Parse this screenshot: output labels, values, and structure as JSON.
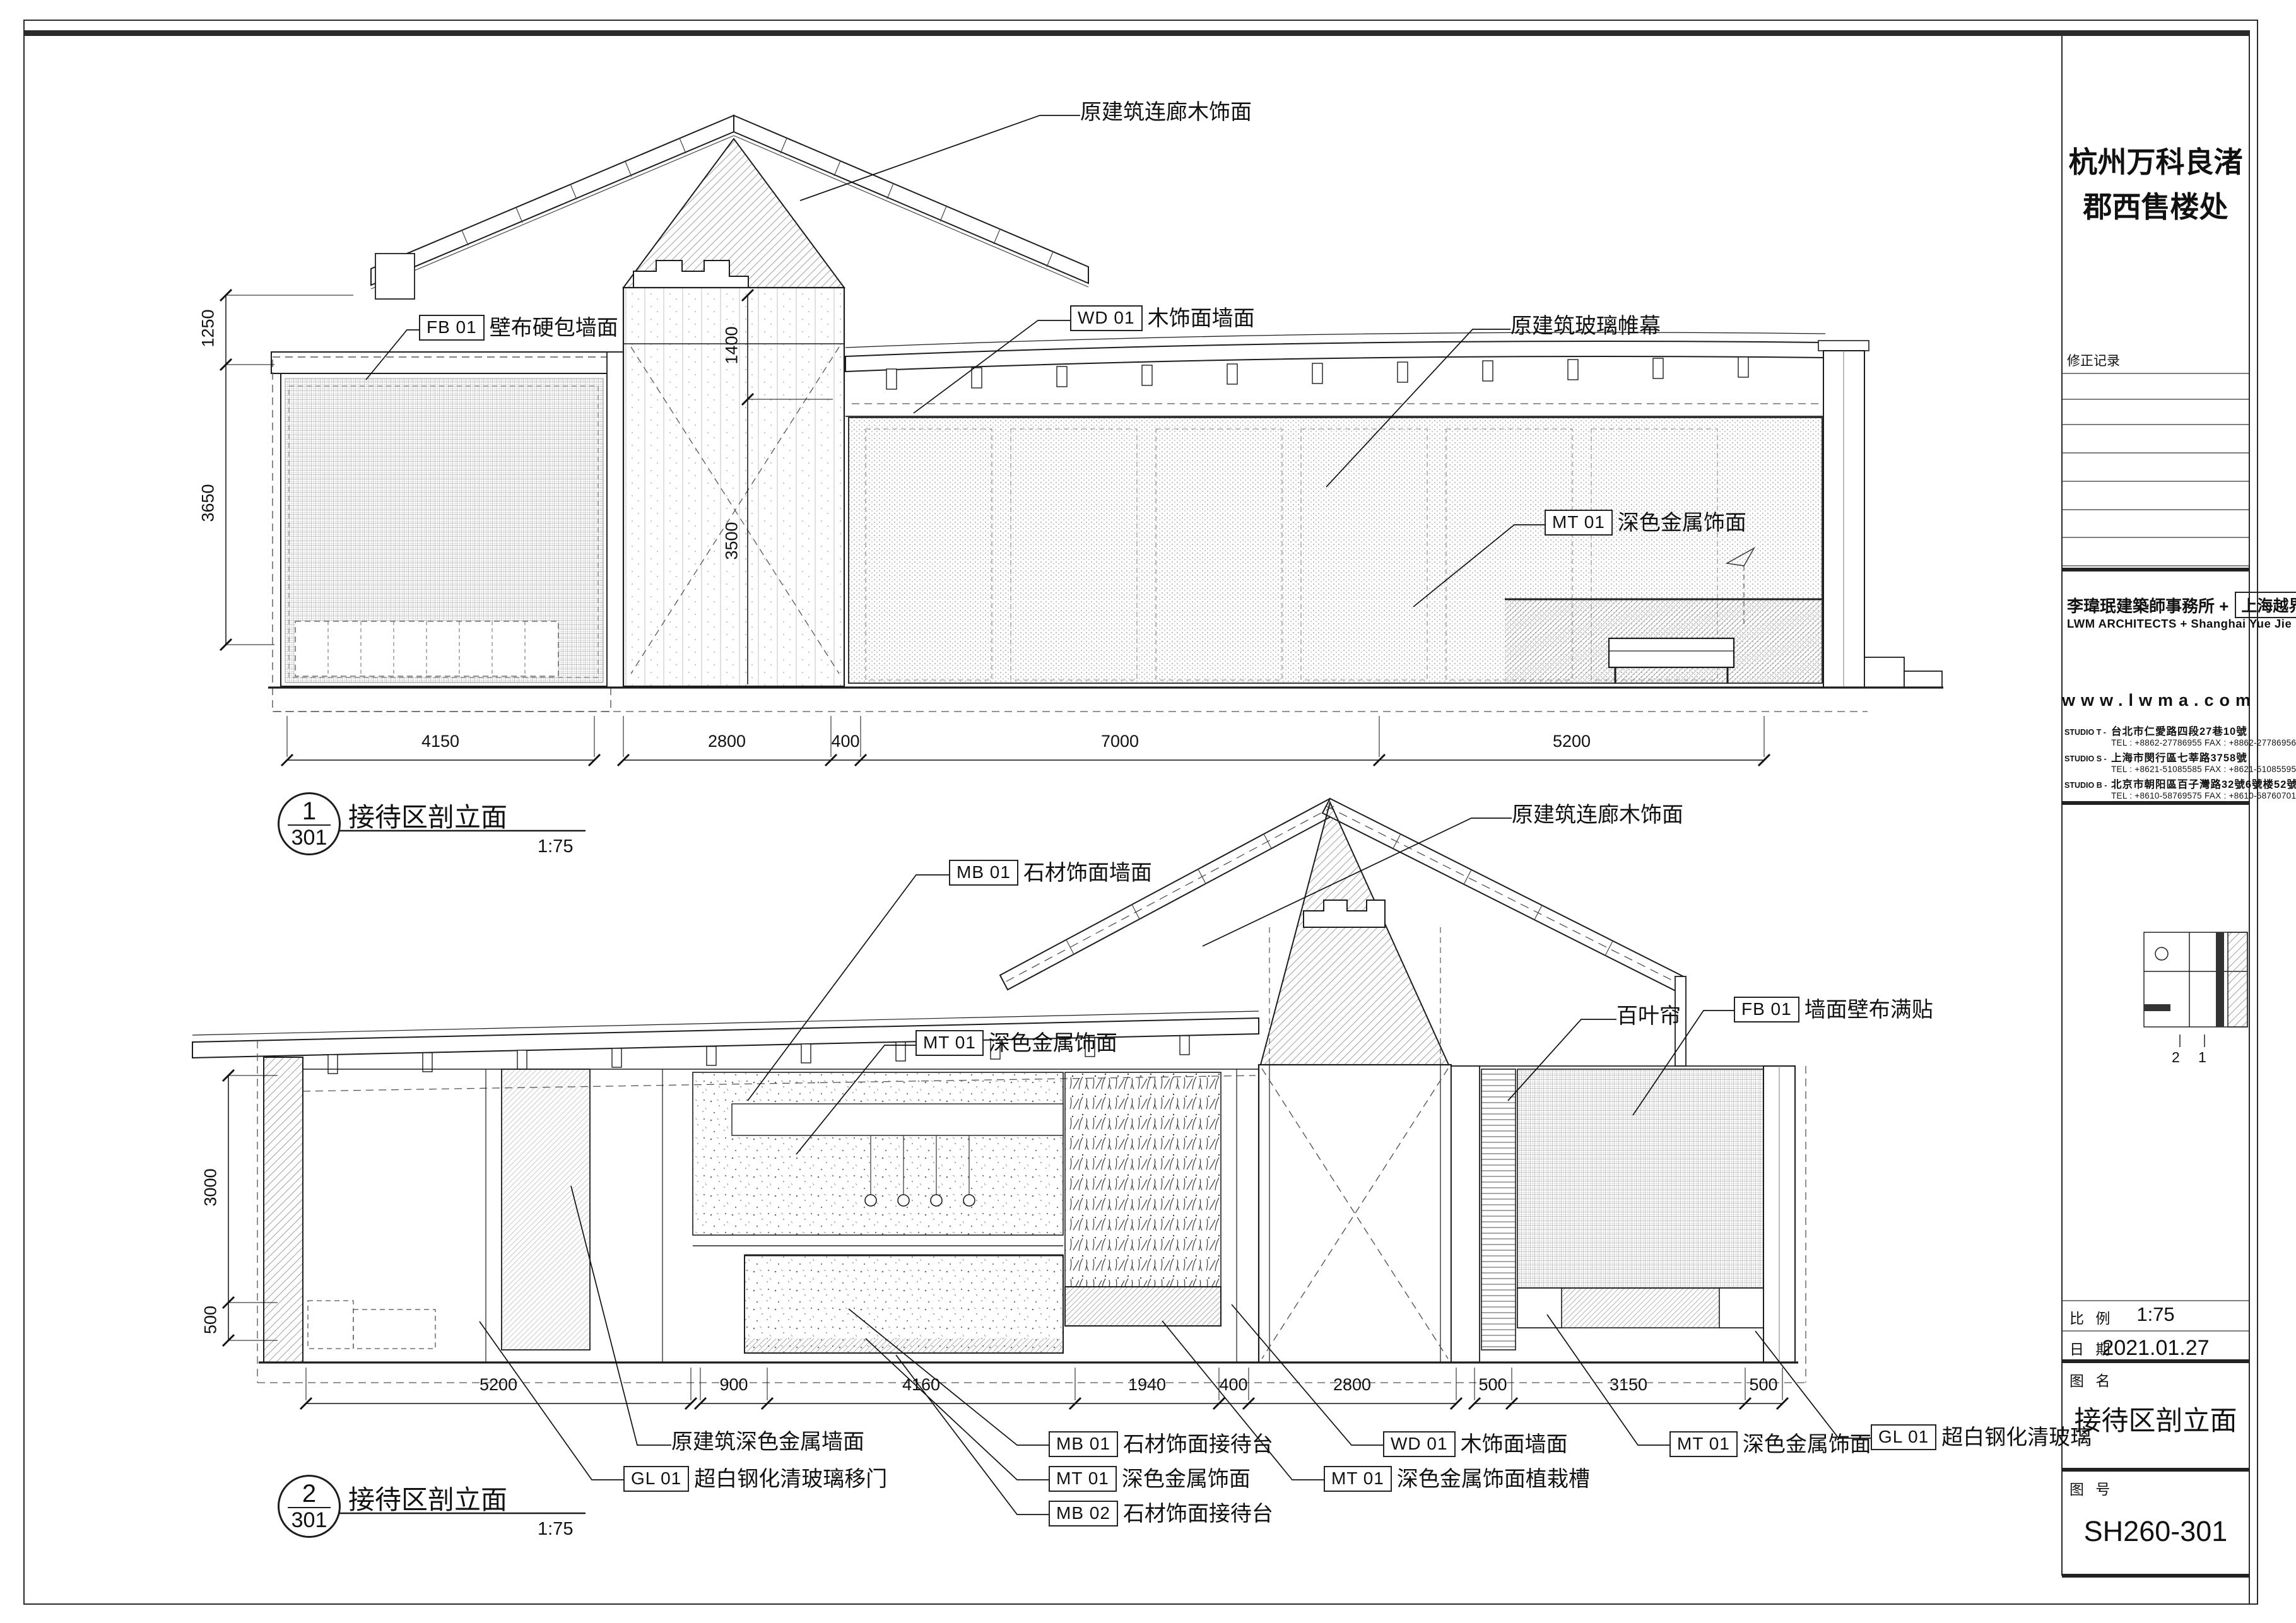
{
  "title_block": {
    "project_name_1": "杭州万科良渚",
    "project_name_2": "郡西售楼处",
    "revision_label": "修正记录",
    "firm_cn": "李瑋珉建築師事務所 +",
    "firm_box": "上海越界",
    "firm_en": "LWM ARCHITECTS + Shanghai Yue Jie",
    "website": "www.lwma.com",
    "studios": [
      {
        "label": "STUDIO T -",
        "address": "台北市仁愛路四段27巷10號",
        "tel": "TEL : +8862-27786955   FAX : +8862-27786956"
      },
      {
        "label": "STUDIO S -",
        "address": "上海市閔行區七莘路3758號",
        "tel": "TEL : +8621-51085585   FAX : +8621-51085595"
      },
      {
        "label": "STUDIO B -",
        "address": "北京市朝阳區百子灣路32號6號楼52號",
        "tel": "TEL : +8610-58769575   FAX : +8610-58760701"
      }
    ],
    "keyplan_marks": [
      "2",
      "1"
    ],
    "scale_label": "比 例",
    "scale_value": "1:75",
    "date_label": "日 期",
    "date_value": "2021.01.27",
    "name_label": "图 名",
    "name_value": "接待区剖立面",
    "number_label": "图 号",
    "number_value": "SH260-301"
  },
  "d1": {
    "bubble_num": "1",
    "bubble_sheet": "301",
    "title": "接待区剖立面",
    "scale": "1:75",
    "callouts": [
      {
        "tag": "",
        "text": "原建筑连廊木饰面"
      },
      {
        "tag": "FB 01",
        "text": "壁布硬包墙面"
      },
      {
        "tag": "WD 01",
        "text": "木饰面墙面"
      },
      {
        "tag": "",
        "text": "原建筑玻璃帷幕"
      },
      {
        "tag": "MT 01",
        "text": "深色金属饰面"
      }
    ],
    "dims_bottom": [
      "4150",
      "2800",
      "400",
      "7000",
      "5200"
    ],
    "dims_left": [
      "1250",
      "3650"
    ],
    "dims_inner": [
      "1400",
      "3500"
    ]
  },
  "d2": {
    "bubble_num": "2",
    "bubble_sheet": "301",
    "title": "接待区剖立面",
    "scale": "1:75",
    "callouts": [
      {
        "tag": "MB 01",
        "text": "石材饰面墙面"
      },
      {
        "tag": "MT 01",
        "text": "深色金属饰面"
      },
      {
        "tag": "",
        "text": "原建筑连廊木饰面"
      },
      {
        "tag": "",
        "text": "百叶帘"
      },
      {
        "tag": "FB 01",
        "text": "墙面壁布满贴"
      },
      {
        "tag": "",
        "text": "原建筑深色金属墙面"
      },
      {
        "tag": "GL 01",
        "text": "超白钢化清玻璃移门"
      },
      {
        "tag": "MB 01",
        "text": "石材饰面接待台"
      },
      {
        "tag": "MT 01",
        "text": "深色金属饰面"
      },
      {
        "tag": "MB 02",
        "text": "石材饰面接待台"
      },
      {
        "tag": "WD 01",
        "text": "木饰面墙面"
      },
      {
        "tag": "MT 01",
        "text": "深色金属饰面植栽槽"
      },
      {
        "tag": "MT 01",
        "text": "深色金属饰面"
      },
      {
        "tag": "GL 01",
        "text": "超白钢化清玻璃"
      }
    ],
    "dims_bottom": [
      "5200",
      "900",
      "4160",
      "1940",
      "400",
      "2800",
      "500",
      "3150",
      "500"
    ],
    "dims_left": [
      "3000",
      "500"
    ]
  }
}
